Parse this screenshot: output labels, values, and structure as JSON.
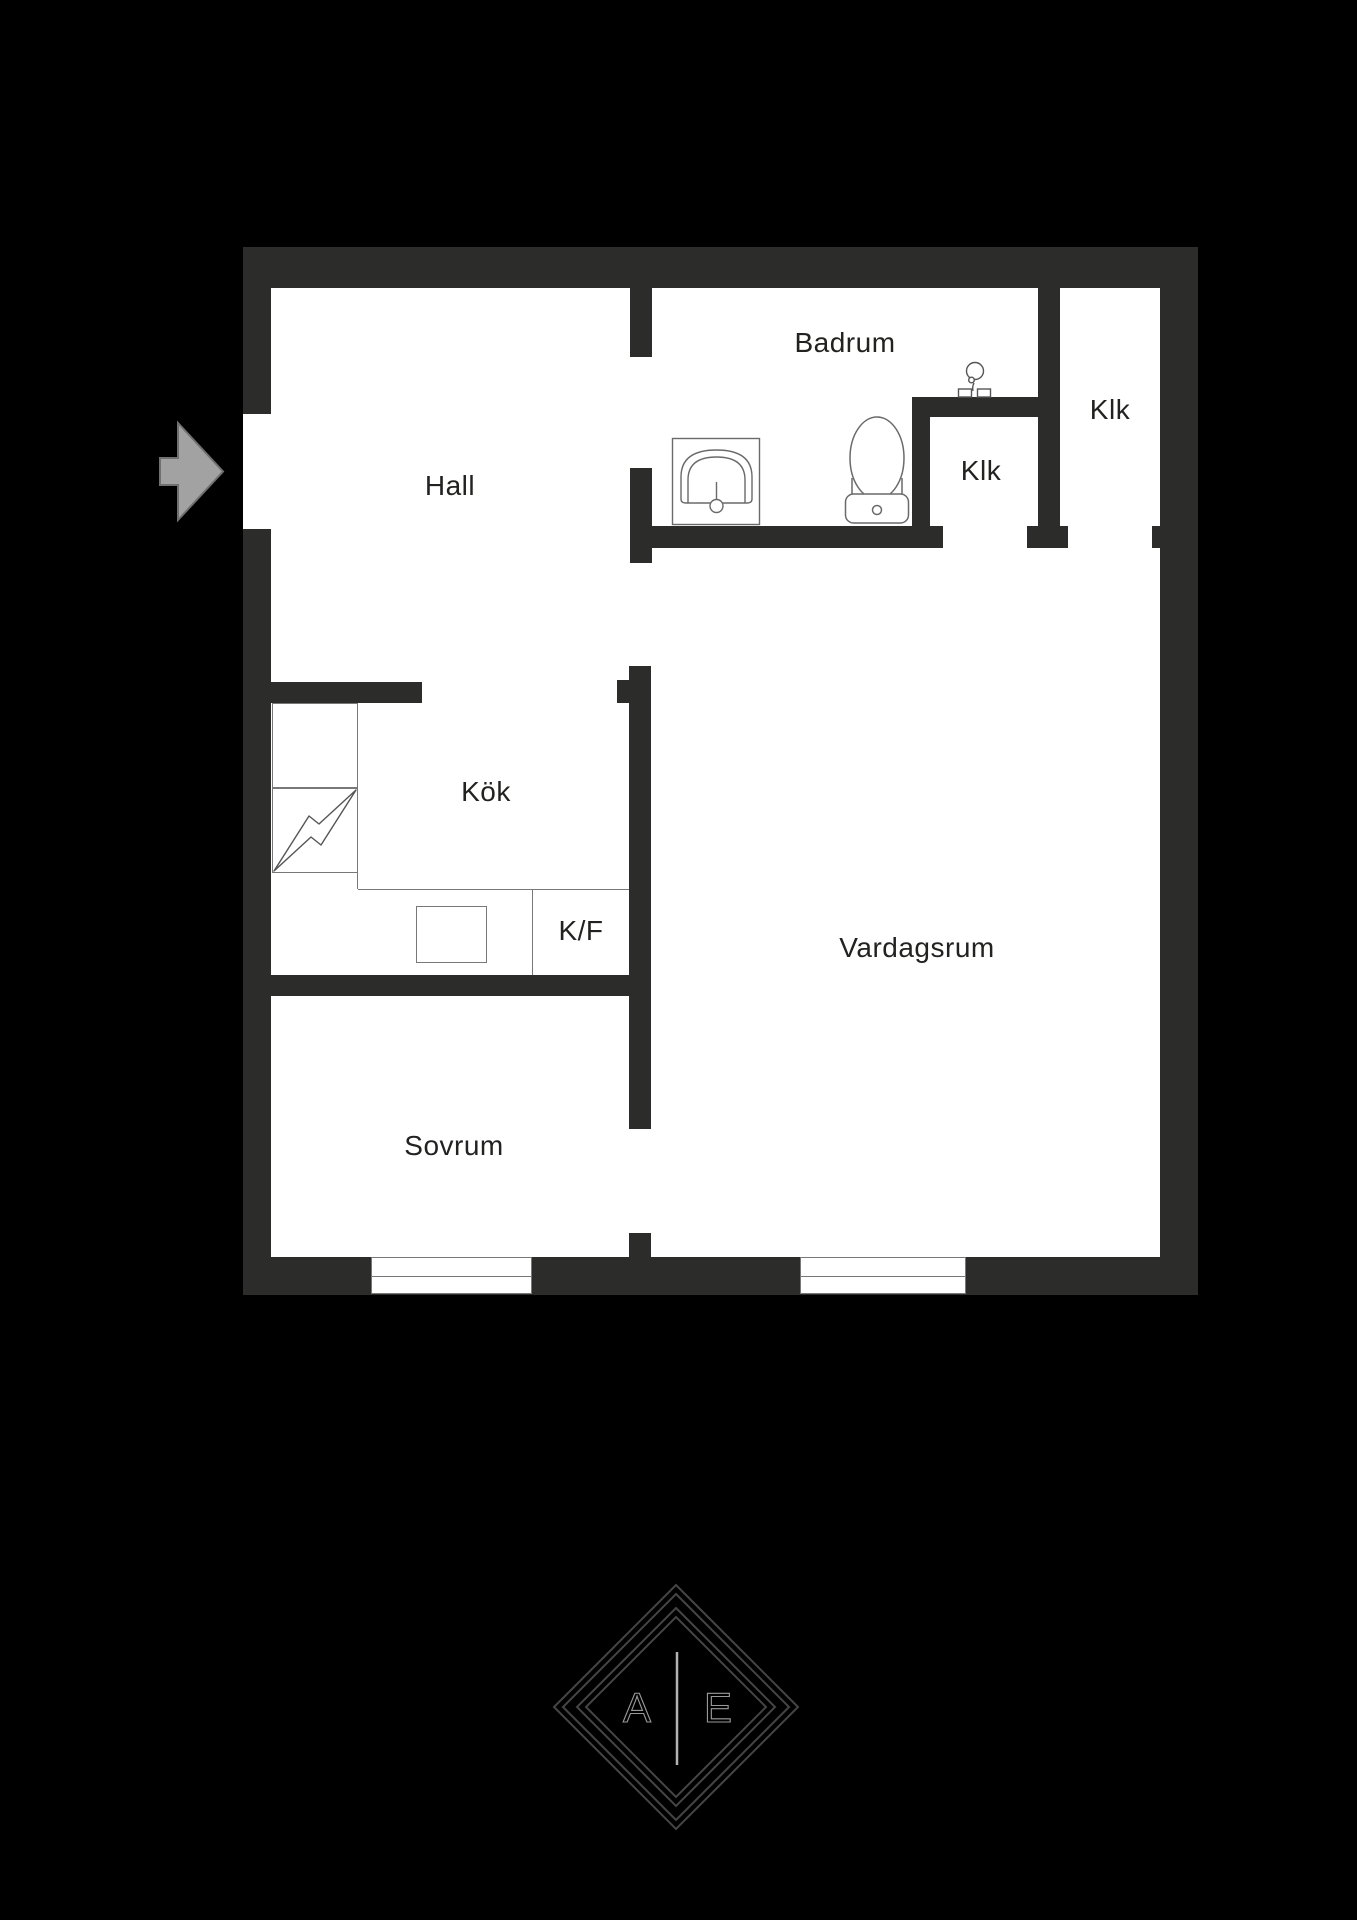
{
  "plan": {
    "type": "apartment floor plan",
    "rooms": {
      "hall": {
        "label": "Hall"
      },
      "badrum": {
        "label": "Badrum"
      },
      "klk_inner": {
        "label": "Klk"
      },
      "klk_right": {
        "label": "Klk"
      },
      "kok": {
        "label": "Kök"
      },
      "kf": {
        "label": "K/F"
      },
      "vardagsrum": {
        "label": "Vardagsrum"
      },
      "sovrum": {
        "label": "Sovrum"
      }
    },
    "icons": {
      "entrance": "entrance-arrow-icon",
      "washbasin": "washbasin-icon",
      "toilet": "toilet-icon",
      "mixer_tap": "mixer-tap-icon",
      "electric_stove_symbol": "lightning-icon",
      "stove": "stove-icon",
      "windows": "window-symbol"
    },
    "colors": {
      "background": "#000000",
      "wall": "#2c2c2a",
      "floor": "#ffffff",
      "fixture_line": "#6a6a6a",
      "text": "#222220",
      "arrow_fill": "#a2a2a2",
      "arrow_stroke": "#707070"
    }
  },
  "logo": {
    "letter_left": "A",
    "letter_right": "E",
    "line_color": "#454545",
    "letter_color": "#9a9a9a"
  }
}
